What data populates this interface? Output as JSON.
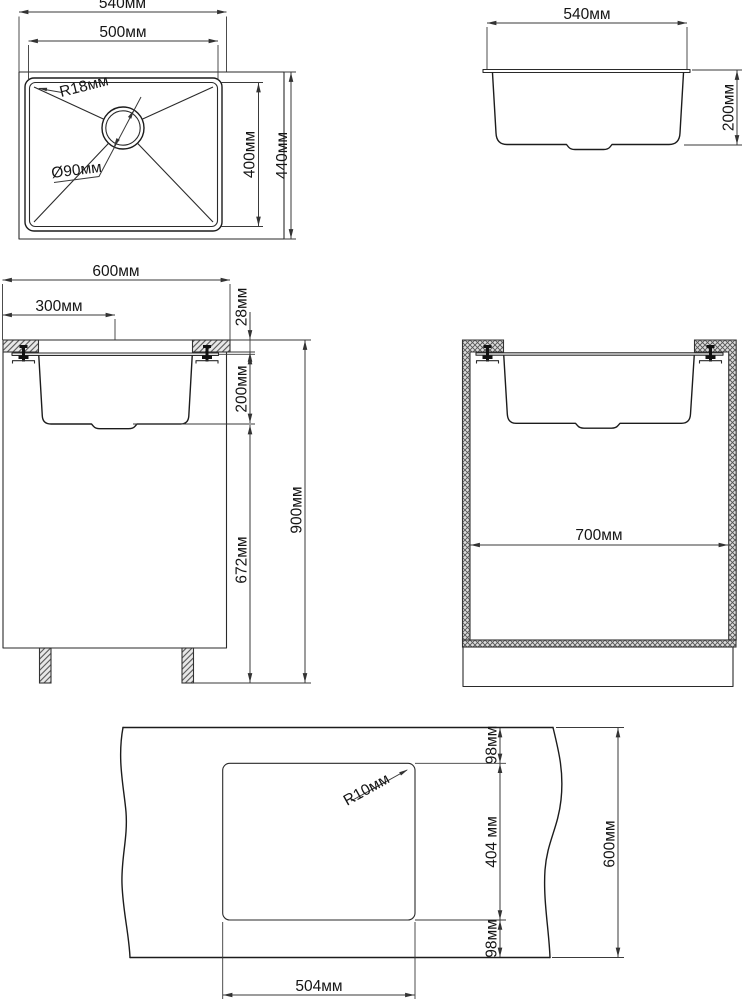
{
  "drawing": {
    "unit": "мм",
    "top_view": {
      "overall_width": "540мм",
      "bowl_width": "500мм",
      "corner_radius": "R18мм",
      "drain_diameter": "Ø90мм",
      "bowl_depth": "400мм",
      "overall_depth": "440мм"
    },
    "side_view": {
      "overall_width": "540мм",
      "bowl_height": "200мм"
    },
    "cabinet_side": {
      "cabinet_depth": "600мм",
      "sink_center_offset": "300мм",
      "countertop_thickness": "28мм",
      "bowl_depth": "200мм",
      "floor_to_bowl": "672мм",
      "worktop_height": "900мм"
    },
    "cabinet_front": {
      "inner_width": "700мм"
    },
    "cutout": {
      "margin_front": "98мм",
      "corner_radius": "R10мм",
      "cutout_depth": "404 мм",
      "margin_back": "98мм",
      "cutout_width": "504мм",
      "countertop_depth": "600мм"
    }
  }
}
